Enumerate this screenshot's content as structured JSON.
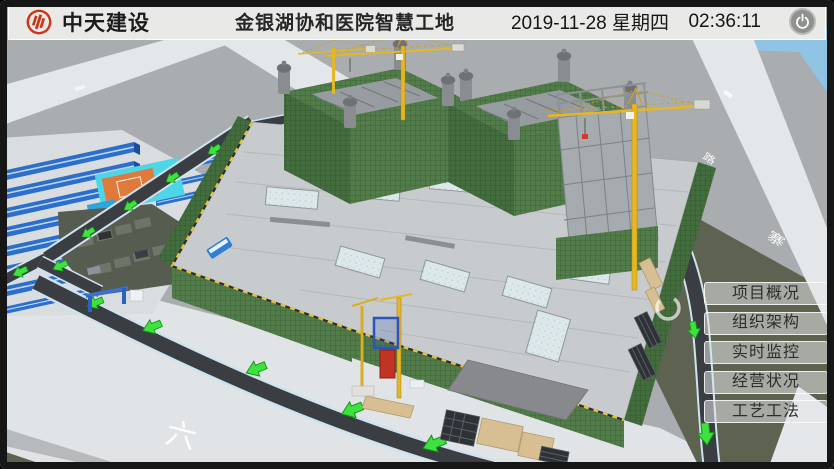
{
  "header": {
    "company": "中天建设",
    "title": "金银湖协和医院智慧工地",
    "date": "2019-11-28 星期四",
    "time": "02:36:11"
  },
  "menu": {
    "items": [
      {
        "label": "项目概况"
      },
      {
        "label": "组织架构"
      },
      {
        "label": "实时监控"
      },
      {
        "label": "经营状况"
      },
      {
        "label": "工艺工法"
      }
    ]
  },
  "scene": {
    "road_markings": {
      "apron": "六",
      "right_road_mid": "路",
      "right_road_south": "寨"
    },
    "colors": {
      "ground": "#a9adb0",
      "sky": "#90c4e4",
      "road_light": "#e4e7ea",
      "road_dark": "#3a3e42",
      "road_casing": "#cfe2ee",
      "apron": "#e0e4e7",
      "field_green": "#5d6350",
      "slab_gray": "#c7cbce",
      "scaffold_green": "#527c4a",
      "scaffold_dark": "#446d3e",
      "roof_blue": "#2b6ecb",
      "court_cyan": "#4cd6e6",
      "court_orange": "#e07a3a",
      "crane_yellow": "#e5b722",
      "arrow_green": "#3de23f",
      "hoist_red": "#c03424",
      "tan": "#d7bf93",
      "steel_gray": "#a6abaf",
      "camp_slab": "#dadde0",
      "logo_red": "#cf3318"
    }
  }
}
